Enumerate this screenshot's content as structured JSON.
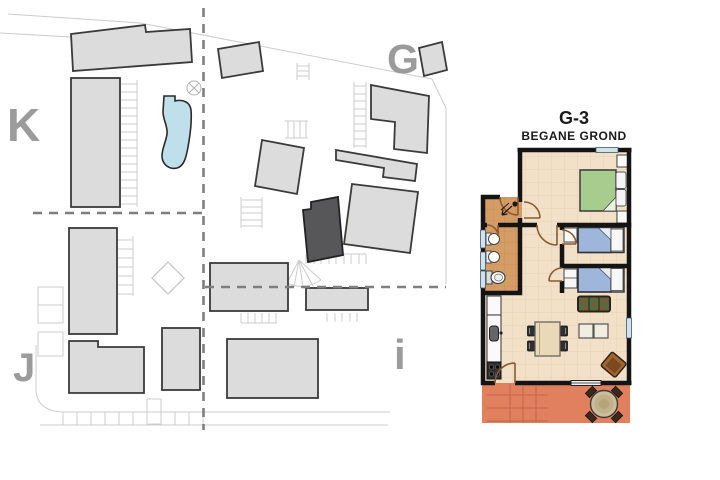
{
  "site_plan": {
    "labels": {
      "block_k": "K",
      "block_g": "G",
      "block_j": "J",
      "block_i": "i"
    },
    "colors": {
      "building_fill": "#dcdcdc",
      "building_stroke": "#3a3a3a",
      "highlighted_building": "#57575a",
      "pool": "#bfe0ea",
      "label": "#9b9b9b",
      "dashed_line": "#7f7f7f",
      "road_line": "#cccccc"
    }
  },
  "floor_plan": {
    "unit_title": "G-3",
    "floor_subtitle": "BEGANE GROND",
    "colors": {
      "wall": "#141414",
      "floor": "#f2e0c8",
      "hall_floor": "#d59d66",
      "terrace": "#e0805f",
      "double_bed": "#a8cc8e",
      "single_bed": "#9fb6dc",
      "window": "#cfe3ec",
      "door": "#8a5a30"
    }
  }
}
